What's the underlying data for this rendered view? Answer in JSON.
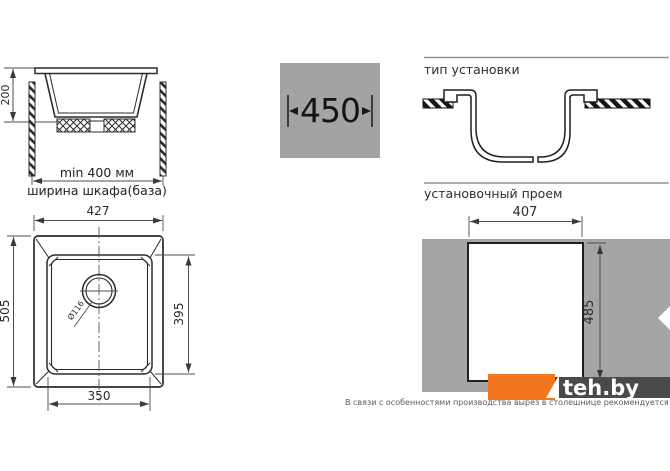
{
  "colors": {
    "accent_orange": "#f4771f",
    "panel_gray": "#a3a3a3",
    "countertop_gray": "#a5a5a5",
    "line_dark": "#2b2b2b",
    "watermark_bar": "#4a4a4a"
  },
  "side_view": {
    "depth": "200",
    "min_width": "min 400 мм",
    "cabinet_width": "ширина шкафа(база)"
  },
  "cabinet_badge": {
    "size": "450"
  },
  "installation": {
    "title": "тип установки"
  },
  "cutout": {
    "title": "установочный проем",
    "width": "407",
    "height": "485"
  },
  "top_view": {
    "overall_width": "427",
    "overall_depth": "505",
    "bowl_depth": "395",
    "bowl_width": "350",
    "drain_diameter": "Ø116"
  },
  "watermark": {
    "site": "teh.by"
  },
  "footnote": "В связи с особенностями производства вырез в столешнице рекомендуется делать в соответствии с изделием"
}
